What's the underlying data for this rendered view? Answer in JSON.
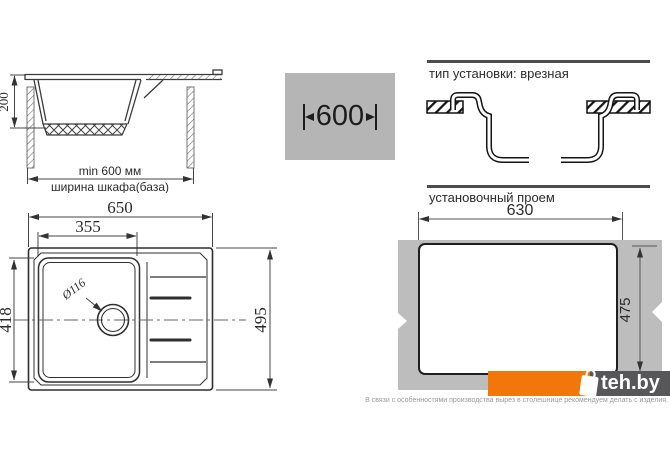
{
  "cabinet_section": {
    "depth": "200",
    "min_width": "min 600 мм",
    "width_caption": "ширина шкафа(база)"
  },
  "size_badge": {
    "width": "600"
  },
  "install": {
    "type_label": "тип установки: врезная",
    "opening_label": "установочный проем",
    "opening_width": "630",
    "opening_depth": "475"
  },
  "plan": {
    "overall_width": "650",
    "bowl_width": "355",
    "bowl_depth": "418",
    "overall_depth": "495",
    "drain_diameter": "Ø116"
  },
  "branding": {
    "logo_text": "teh.by"
  },
  "footer_note": "В связи с особенностями производства вырез в столешнице рекомендуем делать с изделия.",
  "colors": {
    "accent_orange": "#f1770a",
    "logo_gray": "#57575a",
    "panel_gray": "#bdbdbd",
    "badge_gray": "#b5b5b5"
  }
}
